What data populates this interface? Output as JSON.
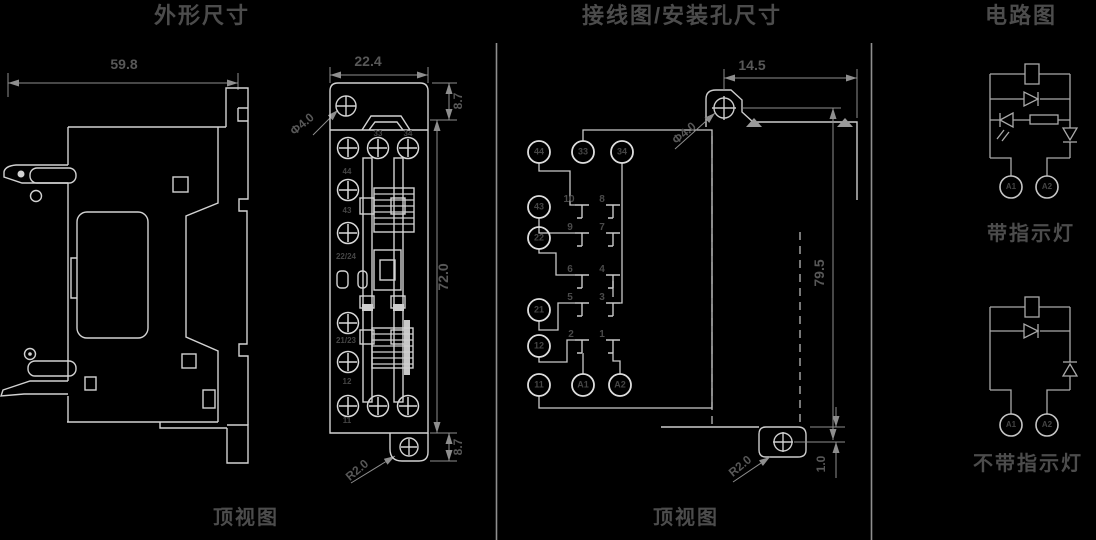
{
  "titles": {
    "outline": "外形尺寸",
    "wiring": "接线图/安装孔尺寸",
    "circuit": "电路图"
  },
  "captions": {
    "outline_view": "顶视图",
    "wiring_view": "顶视图",
    "with_led": "带指示灯",
    "without_led": "不带指示灯"
  },
  "outline": {
    "dims": {
      "overall_width": "59.8",
      "front_width": "22.4",
      "top_tab": "8.7",
      "body_height": "72.0",
      "bottom_tab": "8.7",
      "hole_dia": "Φ4.0",
      "corner_radius": "R2.0"
    },
    "terminals": {
      "t33": "33",
      "t34": "34",
      "t44": "44",
      "t43": "43",
      "t2224": "22/24",
      "t2123": "21/23",
      "t12": "12",
      "t11": "11"
    }
  },
  "wiring": {
    "dims": {
      "hole_offset": "14.5",
      "hole_dia": "Φ4.0",
      "hole_spacing": "79.5",
      "corner_radius": "R2.0",
      "edge_offset": "1.0"
    },
    "terminals": {
      "c44": "44",
      "c33": "33",
      "c34": "34",
      "c43": "43",
      "c22": "22",
      "c21": "21",
      "c12": "12",
      "c11": "11",
      "ca1": "A1",
      "ca2": "A2"
    },
    "pins": {
      "p10": "10",
      "p9": "9",
      "p8": "8",
      "p7": "7",
      "p6": "6",
      "p5": "5",
      "p4": "4",
      "p3": "3",
      "p2": "2",
      "p1": "1"
    }
  },
  "circuit": {
    "terminals": {
      "a1_top": "A1",
      "a2_top": "A2",
      "a1_bottom": "A1",
      "a2_bottom": "A2"
    }
  },
  "colors": {
    "background": "#000000",
    "line": "#d2d2d2",
    "dim_line": "#8e8e8e",
    "title_text": "#4c4c4c",
    "dim_text": "#585858"
  }
}
